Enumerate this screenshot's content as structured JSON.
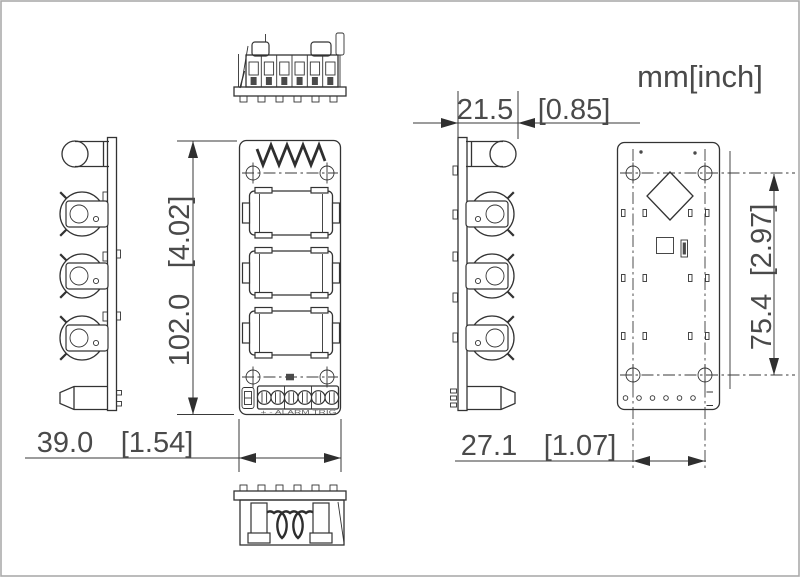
{
  "title_units": "mm[inch]",
  "dims": {
    "side_depth": {
      "mm": "21.5",
      "inch": "[0.85]"
    },
    "body_height": {
      "mm": "102.0",
      "inch": "[4.02]"
    },
    "body_width": {
      "mm": "39.0",
      "inch": "[1.54]"
    },
    "hole_spacing_x": {
      "mm": "27.1",
      "inch": "[1.07]"
    },
    "hole_spacing_y": {
      "mm": "75.4",
      "inch": "[2.97]"
    }
  },
  "labels": {
    "terminal_strip": "+ - ALARM TRIG"
  },
  "colors": {
    "line": "#333333",
    "dimension_text": "#4a4a4a",
    "background": "#ffffff",
    "frame": "#ababab"
  }
}
